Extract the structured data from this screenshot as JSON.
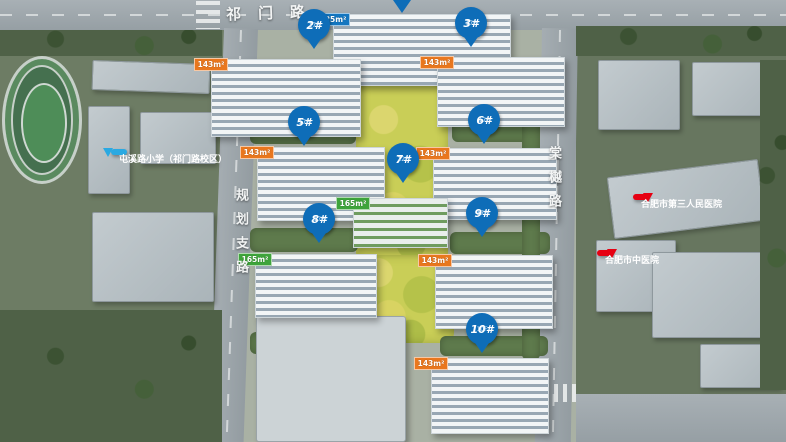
{
  "roads": {
    "top": "祁门路",
    "left": "规划支路",
    "right": "棠樾路"
  },
  "pois": {
    "school": "屯溪路小学（祁门路校区）",
    "hospital_1": "合肥市第三人民医院",
    "hospital_2": "合肥市中医院"
  },
  "pins": {
    "p2": {
      "label": "2#",
      "floors": "17F"
    },
    "p3": {
      "label": "3#",
      "floors": "17F"
    },
    "p5": {
      "label": "5#",
      "floors": "17F"
    },
    "p6": {
      "label": "6#",
      "floors": "17F"
    },
    "p7": {
      "label": "7#",
      "floors": "12F"
    },
    "p8": {
      "label": "8#",
      "floors": "17F"
    },
    "p9": {
      "label": "9#",
      "floors": "17F"
    },
    "p10": {
      "label": "10#",
      "floors": "10F"
    }
  },
  "buildings": {
    "b1": {
      "tags": [
        {
          "area": "125m²"
        },
        {
          "area": "105m²"
        },
        {
          "area": "105m²"
        },
        {
          "area": "125m²"
        }
      ]
    },
    "b2": {
      "tags": [
        {
          "area": "143m²"
        },
        {
          "area": "125m²"
        },
        {
          "area": "125m²"
        },
        {
          "area": "143m²"
        }
      ]
    },
    "b3": {
      "tags": [
        {
          "area": "143m²"
        },
        {
          "area": "125m²"
        },
        {
          "area": "125m²"
        },
        {
          "area": "143m²"
        }
      ]
    },
    "b5": {
      "tags": [
        {
          "area": "143m²"
        },
        {
          "area": "125m²"
        },
        {
          "area": "125m²"
        },
        {
          "area": "143m²"
        }
      ]
    },
    "b6": {
      "tags": [
        {
          "area": "143m²"
        },
        {
          "area": "125m²"
        },
        {
          "area": "125m²"
        },
        {
          "area": "143m²"
        }
      ]
    },
    "b7": {
      "tags": [
        {
          "area": "165m²"
        },
        {
          "area": "165m²"
        }
      ]
    },
    "b8": {
      "tags": [
        {
          "area": "165m²"
        },
        {
          "area": "165m²"
        },
        {
          "area": "165m²"
        },
        {
          "area": "165m²"
        }
      ]
    },
    "b9": {
      "tags": [
        {
          "area": "143m²"
        },
        {
          "area": "125m²"
        },
        {
          "area": "125m²"
        },
        {
          "area": "143m²"
        }
      ]
    },
    "b10": {
      "tags": [
        {
          "area": "143m²"
        },
        {
          "area": "143m²"
        },
        {
          "area": "143m²"
        },
        {
          "area": "143m²"
        }
      ]
    }
  },
  "colors": {
    "pin_blue": "#0e6db8",
    "tag_orange": "#e9771e",
    "tag_blue": "#1376c0",
    "tag_green": "#3ea43b",
    "poi_blue": "#2aa9e2",
    "poi_red": "#e60012"
  }
}
